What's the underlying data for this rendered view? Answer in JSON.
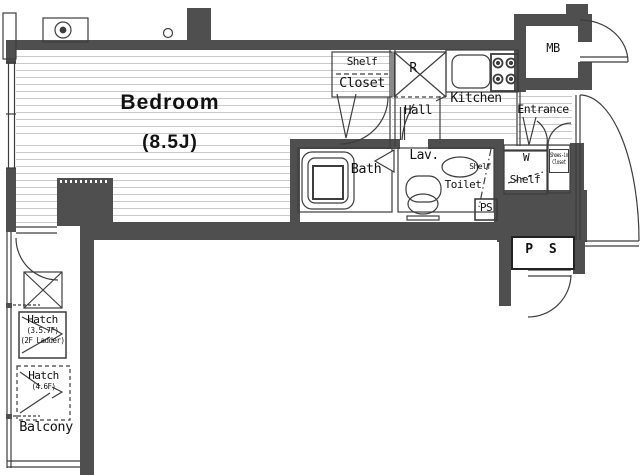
{
  "labels": {
    "bedroom_name": "Bedroom",
    "bedroom_size": "(8.5J)",
    "shelf_closet_top": "Shelf",
    "shelf_closet_bottom": "Closet",
    "refrigerator": "R",
    "kitchen": "Kitchen",
    "meter_box": "MB",
    "entrance": "Entrance",
    "hall": "Hall",
    "lavatory": "Lav.",
    "bath": "Bath",
    "toilet": "Toilet",
    "toilet_shelf": "Shelf",
    "toilet_pipe_space": "PS",
    "washer": "W",
    "washer_shelf": "Shelf",
    "shoes_closet_line1": "Shoes-in",
    "shoes_closet_line2": "Closet",
    "pipe_space": "P S",
    "hatch_upper_title": "Hatch",
    "hatch_upper_floors": "(3.5.7F)",
    "hatch_upper_note": "(2F Ladder)",
    "hatch_lower_title": "Hatch",
    "hatch_lower_floors": "(4.6F)",
    "balcony": "Balcony"
  },
  "colors": {
    "wall": "#4f4f4f",
    "outline": "#3d3d3d",
    "floor_line": "#cacaca",
    "text": "#111111"
  }
}
